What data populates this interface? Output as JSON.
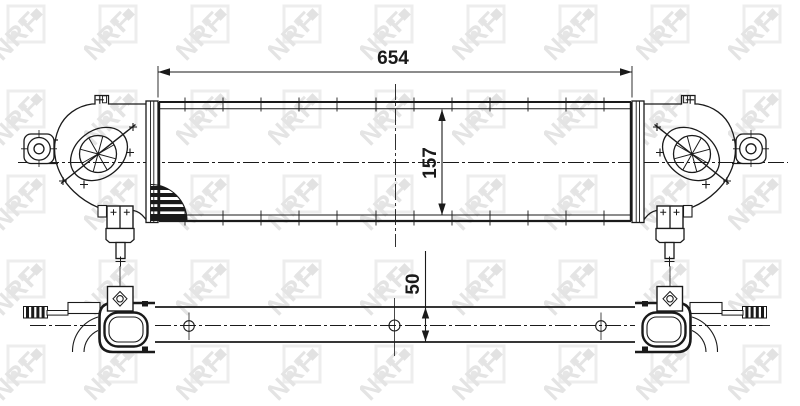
{
  "watermark": {
    "text": "NRF"
  },
  "dimensions": {
    "width": "654",
    "height": "157",
    "depth": "50"
  },
  "colors": {
    "line": "#1a1a1a",
    "background": "#ffffff",
    "watermark": "#e8e8e8"
  }
}
